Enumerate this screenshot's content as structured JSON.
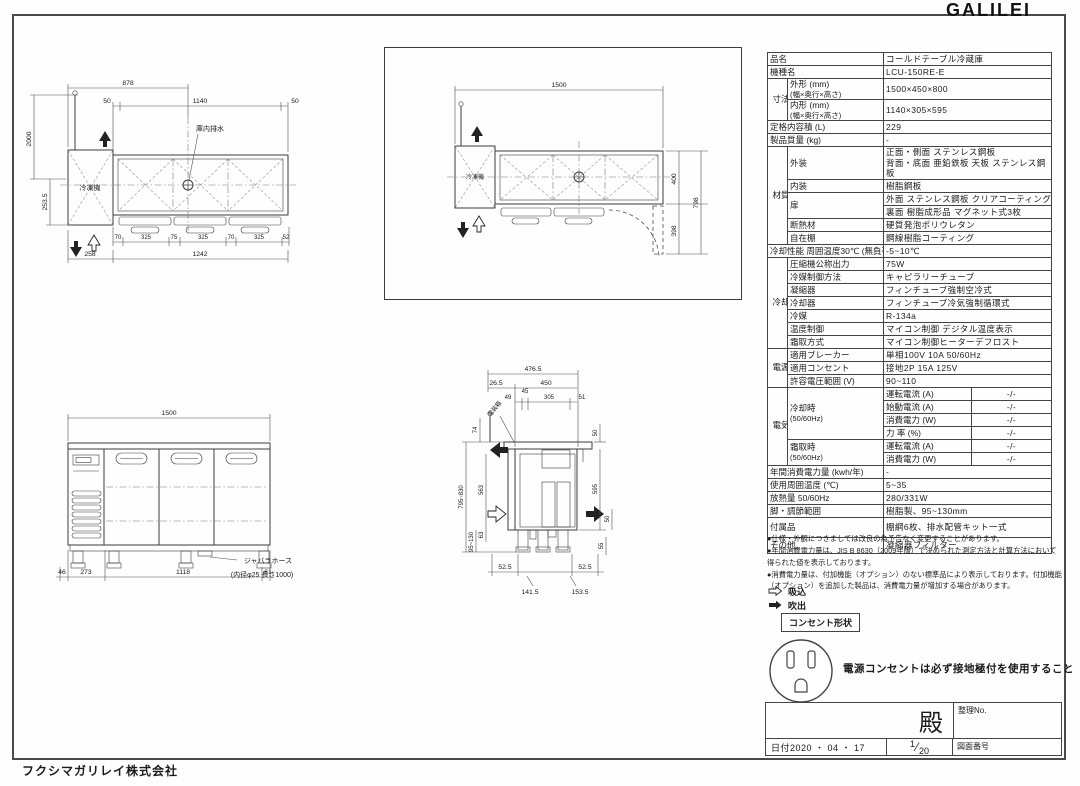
{
  "logo": "GALILEI",
  "company": "フクシマガリレイ株式会社",
  "spec": {
    "product_name_label": "品名",
    "product_name": "コールドテーブル冷蔵庫",
    "model_label": "機種名",
    "model": "LCU-150RE-E",
    "dims_group": "寸法",
    "outer_label": "外形 (mm)",
    "outer_sub": "(幅×奥行×高さ)",
    "outer": "1500×450×800",
    "inner_label": "内形 (mm)",
    "inner_sub": "(幅×奥行×高さ)",
    "inner": "1140×305×595",
    "capacity_label": "定格内容積 (L)",
    "capacity": "229",
    "weight_label": "製品質量 (kg)",
    "weight": "-",
    "material_group": "材質",
    "exterior_label": "外装",
    "exterior1": "正面・側面 ステンレス鋼板",
    "exterior2": "背面・底面 亜鉛鉄板  天板 ステンレス鋼板",
    "interior_label": "内装",
    "interior": "樹脂鋼板",
    "door_label": "扉",
    "door1": "外面 ステンレス鋼板 クリアコーティング",
    "door2": "裏面 樹脂成形品 マグネット式3枚",
    "insulation_label": "断熱材",
    "insulation": "硬質発泡ポリウレタン",
    "shelf_label": "自在棚",
    "shelf": "鋼線樹脂コーティング",
    "cooling_perf_label": "冷却性能 周囲温度30℃ (無負荷)",
    "cooling_perf": "-5~10℃",
    "cooling_group": "冷却装置",
    "compressor_label": "圧縮機公称出力",
    "compressor": "75W",
    "refrigerant_ctrl_label": "冷媒制御方法",
    "refrigerant_ctrl": "キャピラリーチューブ",
    "condenser_label": "凝縮器",
    "condenser": "フィンチューブ強制空冷式",
    "cooler_label": "冷却器",
    "cooler": "フィンチューブ冷気強制循環式",
    "refrigerant_label": "冷媒",
    "refrigerant": "R-134a",
    "temp_ctrl_label": "温度制御",
    "temp_ctrl": "マイコン制御 デジタル温度表示",
    "defrost_label": "霜取方式",
    "defrost": "マイコン制御ヒーターデフロスト",
    "power_group": "電源",
    "breaker_label": "適用ブレーカー",
    "breaker": "単相100V 10A 50/60Hz",
    "outlet_label": "適用コンセント",
    "outlet": "接地2P 15A 125V",
    "voltage_label": "許容電圧範囲 (V)",
    "voltage": "90~110",
    "elec_group": "電気特性",
    "cooling_time_label": "冷却時",
    "cooling_time_sub": "(50/60Hz)",
    "run_current_label": "運転電流 (A)",
    "run_current": "-/-",
    "start_current_label": "始動電流 (A)",
    "start_current": "-/-",
    "power_label": "消費電力 (W)",
    "power": "-/-",
    "factor_label": "力 率 (%)",
    "factor": "-/-",
    "defrost_time_label": "霜取時",
    "defrost_time_sub": "(50/60Hz)",
    "defrost_run_label": "運転電流 (A)",
    "defrost_run": "-/-",
    "defrost_power_label": "消費電力 (W)",
    "defrost_power": "-/-",
    "annual_label": "年間消費電力量 (kwh/年)",
    "annual": "-",
    "ambient_label": "使用周囲温度 (℃)",
    "ambient": "5~35",
    "heat_label": "放熱量 50/60Hz",
    "heat": "280/331W",
    "legs_label": "脚・調節範囲",
    "legs": "樹脂製、95~130mm",
    "accessories_label": "付属品",
    "accessories": "棚網6枚、排水配管キット一式",
    "other_label": "その他",
    "other": "凝縮器フィルター"
  },
  "notes": [
    "●仕様・外観につきましては改良の為予告なく変更することがあります。",
    "●年間消費電力量は、JIS B 8630（2009年版）で決められた測定方法と計算方法において得られた値を表示しております。",
    "●消費電力量は、付加機能（オプション）のない標準品により表示しております。付加機能（オプション）を追加した製品は、消費電力量が増加する場合があります。"
  ],
  "legend": {
    "intake": "吸込",
    "blowout": "吹出",
    "outlet_shape": "コンセント形状",
    "warning": "電源コンセントは必ず接地極付を使用すること"
  },
  "title_block": {
    "dono": "殿",
    "seiri_no": "整理No.",
    "date": "日付2020 ・ 04 ・ 17",
    "scale_num": "1",
    "scale_den": "20",
    "drawing_no": "図面番号"
  },
  "drawings": {
    "plan_left": {
      "w878": "878",
      "w50l": "50",
      "w1140": "1140",
      "w50r": "50",
      "h2000": "2000",
      "h253": "253.5",
      "c70a": "70",
      "c325a": "325",
      "c75": "75",
      "c325b": "325",
      "c70b": "70",
      "c325c": "325",
      "c52": "52",
      "w258": "258",
      "w1242": "1242",
      "drain_label": "庫内排水",
      "machine_label": "冷凍機"
    },
    "plan_right": {
      "w1500": "1500",
      "h400": "400",
      "h398": "398",
      "h798": "798",
      "machine_label": "冷凍機"
    },
    "front": {
      "w1500": "1500",
      "c46": "46",
      "c273": "273",
      "c1118": "1118",
      "c61": "61",
      "hose_label": "ジャバラホース",
      "hose_sub": "(内径φ25 長さ1000)"
    },
    "side": {
      "w476": "476.5",
      "w26": "26.5",
      "w450": "450",
      "c49": "49",
      "c45": "45",
      "c305": "305",
      "c51": "51",
      "h74": "74",
      "h795": "795~830",
      "h563": "563",
      "h63": "63",
      "h95": "95~130",
      "r50a": "50",
      "r595": "595",
      "r50b": "50",
      "r55": "55",
      "b52a": "52.5",
      "b52b": "52.5",
      "b141": "141.5",
      "b153": "153.5",
      "ebox_label": "電装箱"
    }
  }
}
